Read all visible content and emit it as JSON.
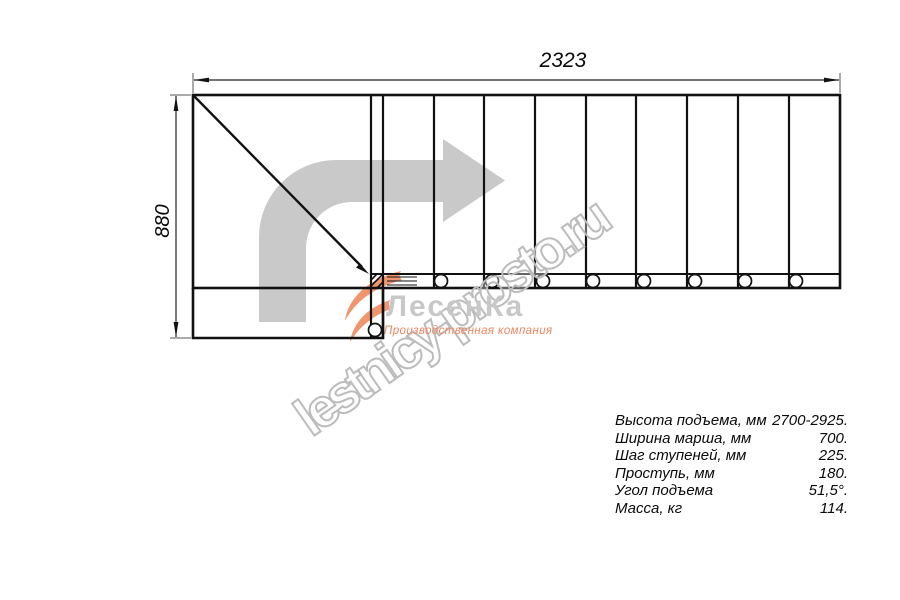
{
  "diagram": {
    "type": "staircase-top-view",
    "step_count": 9,
    "dimensions": {
      "width_label": "2323",
      "height_label": "880"
    },
    "direction_arrow": "turn-right-arrow",
    "line_color": "#111111",
    "arrow_color": "#c9c9c9"
  },
  "watermark": {
    "text": "lestnicy-prosto.ru",
    "outline_color": "#bcbcbc"
  },
  "logo": {
    "name": "ЛесенКа",
    "subtitle": "Производственная компания",
    "name_color": "#c8c8c8",
    "accent_color": "#ee8560"
  },
  "specs": {
    "rows": [
      {
        "label": "Высота подъема, мм",
        "value": "2700-2925."
      },
      {
        "label": "Ширина марша, мм",
        "value": "700."
      },
      {
        "label": "Шаг ступеней, мм",
        "value": "225."
      },
      {
        "label": "Проступь, мм",
        "value": "180."
      },
      {
        "label": "Угол подъема",
        "value": "51,5°."
      },
      {
        "label": "Масса, кг",
        "value": "114."
      }
    ]
  }
}
